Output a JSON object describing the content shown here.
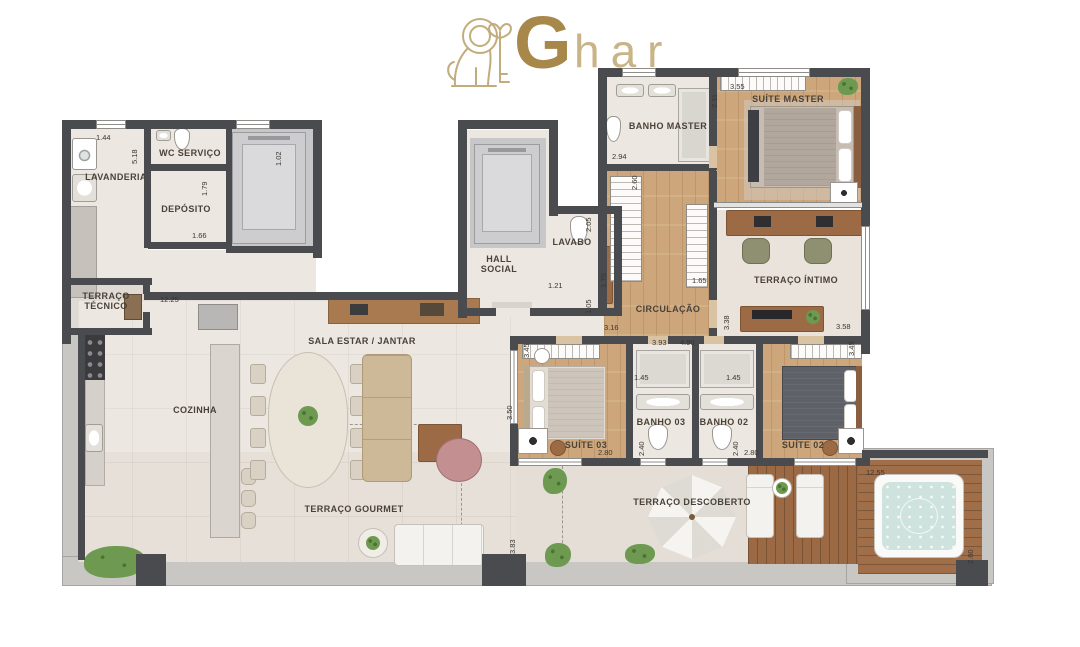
{
  "logo": {
    "brand_g": "G",
    "brand_rest": "har",
    "emblem": "lion-and-key-icon",
    "gold": "#a8874a",
    "gold_light": "#c9b488"
  },
  "plan": {
    "rooms": [
      "LAVANDERIA",
      "WC SERVIÇO",
      "DEPÓSITO",
      "TERRAÇO TÉCNICO",
      "COZINHA",
      "SALA ESTAR / JANTAR",
      "TERRAÇO GOURMET",
      "HALL SOCIAL",
      "LAVABO",
      "BANHO MASTER",
      "SUÍTE MASTER",
      "TERRAÇO ÍNTIMO",
      "CIRCULAÇÃO",
      "SUÍTE 03",
      "BANHO 03",
      "BANHO 02",
      "SUÍTE 02",
      "TERRAÇO DESCOBERTO"
    ],
    "dims": [
      "1.44",
      "5.18",
      "1.02",
      "1.79",
      "1.66",
      "12.25",
      "2.94",
      "2.11",
      "3.55",
      "2.60",
      "1.70",
      "1.65",
      "2.05",
      "1.21",
      "1.05",
      "3.16",
      "3.93",
      "4.90",
      "3.38",
      "3.58",
      "3.45",
      "3.50",
      "2.80",
      "1.45",
      "2.40",
      "1.45",
      "2.40",
      "2.80",
      "3.45",
      "12.55",
      "2.60",
      "3.83"
    ],
    "colors": {
      "wall": "#4a4b4f",
      "wood_floor": "#cda77b",
      "deck": "#9b6a44",
      "floor": "#ece7e0",
      "water": "#cfe3de"
    }
  }
}
